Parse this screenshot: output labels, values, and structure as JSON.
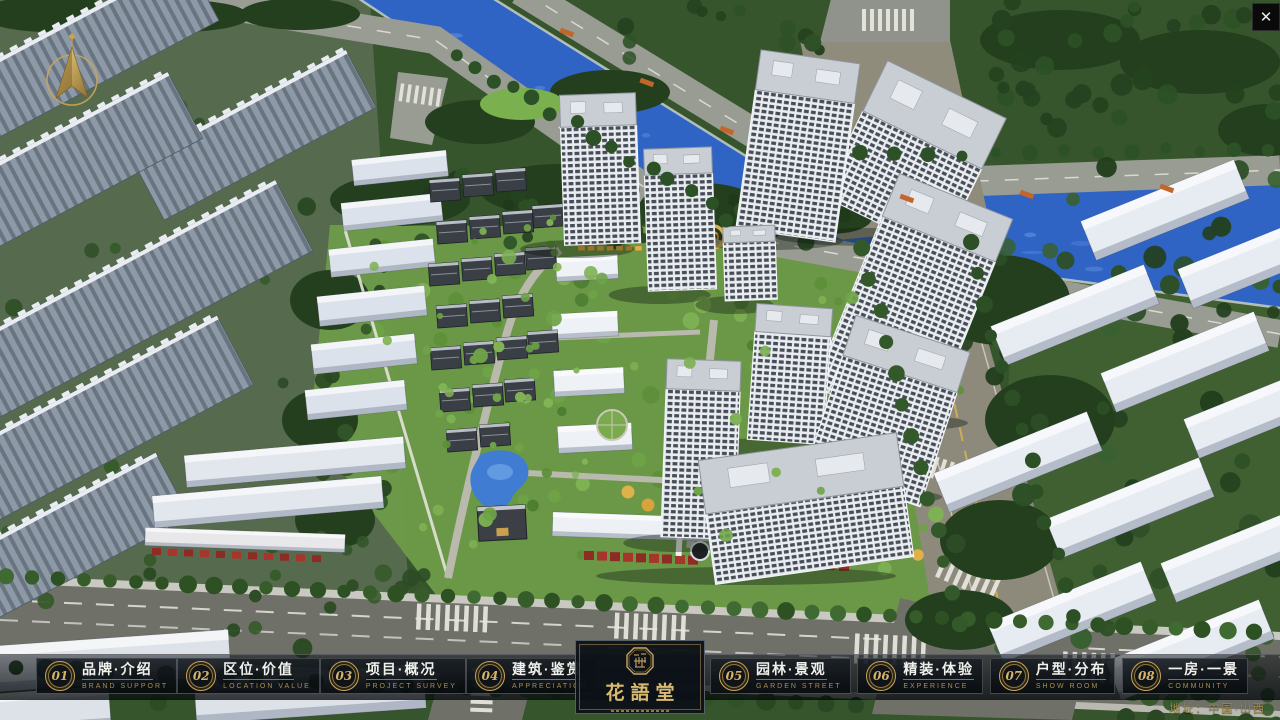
{
  "window": {
    "close_glyph": "✕"
  },
  "nav": {
    "items": [
      {
        "num": "01",
        "zh": "品牌·介绍",
        "en": "BRAND SUPPORT"
      },
      {
        "num": "02",
        "zh": "区位·价值",
        "en": "LOCATION VALUE"
      },
      {
        "num": "03",
        "zh": "项目·概况",
        "en": "PROJECT SURVEY"
      },
      {
        "num": "04",
        "zh": "建筑·鉴赏",
        "en": "APPRECIATION"
      },
      {
        "num": "05",
        "zh": "园林·景观",
        "en": "GARDEN STREET"
      },
      {
        "num": "06",
        "zh": "精装·体验",
        "en": "EXPERIENCE"
      },
      {
        "num": "07",
        "zh": "户型·分布",
        "en": "SHOW ROOM"
      },
      {
        "num": "08",
        "zh": "一房·一景",
        "en": "COMMUNITY"
      }
    ],
    "logo": {
      "title": "花語堂"
    }
  },
  "footer": {
    "address": "地址：中国·山西"
  },
  "colors": {
    "gold": "#c9a35f",
    "gold_dim": "#8f7a42",
    "river": "#2f63c4",
    "river_light": "#5e8ede",
    "grass": "#6d9c49",
    "tree_dark": "#2c4a26",
    "road": "#999c92",
    "road_dark": "#6f7068",
    "road_tan": "#8d8a7b",
    "building_white": "#e7ebf2",
    "accent_red": "#a8352c"
  }
}
